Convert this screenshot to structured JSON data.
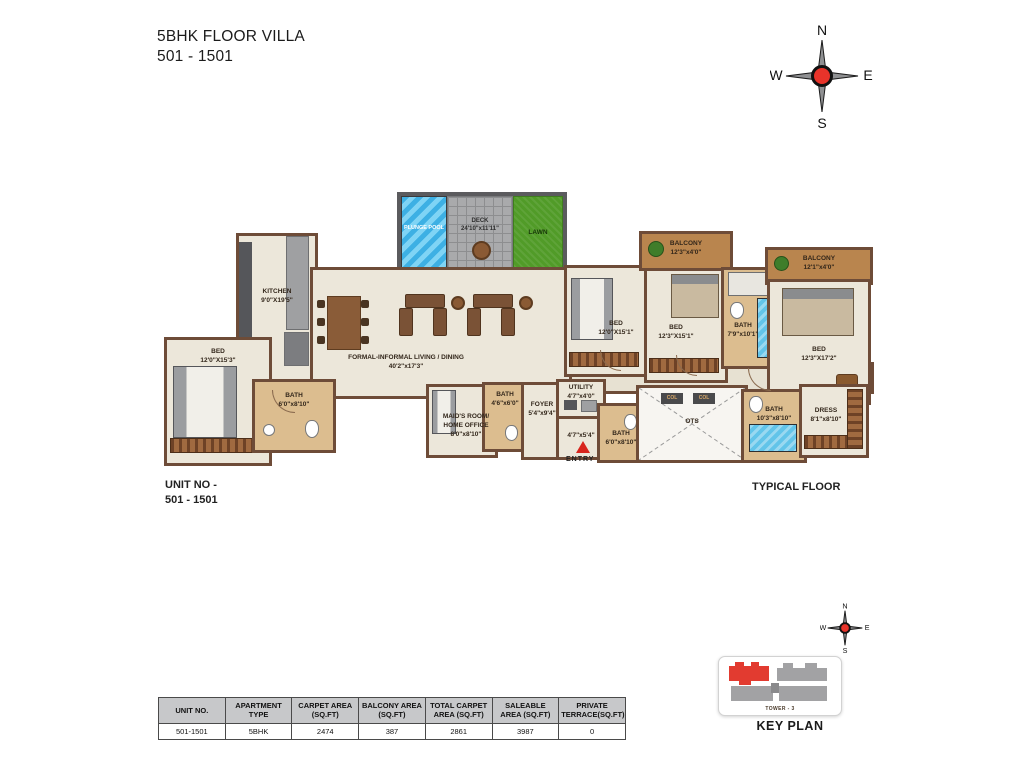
{
  "title": {
    "line1": "5BHK FLOOR VILLA",
    "line2": "501 - 1501"
  },
  "compass": {
    "n": "N",
    "e": "E",
    "s": "S",
    "w": "W"
  },
  "labels": {
    "unit_no_line1": "UNIT NO -",
    "unit_no_line2": "501 - 1501",
    "typical_floor": "TYPICAL FLOOR",
    "key_plan": "KEY PLAN",
    "tower": "TOWER - 3",
    "entry": "ENTRY"
  },
  "rooms": {
    "plunge_pool": {
      "name": "PLUNGE POOL",
      "dim": ""
    },
    "deck": {
      "name": "DECK",
      "dim": "24'10\"x11'11\""
    },
    "lawn": {
      "name": "LAWN",
      "dim": ""
    },
    "kitchen": {
      "name": "KITCHEN",
      "dim": "9'0\"X19'5\""
    },
    "living": {
      "name": "FORMAL-INFORMAL LIVING / DINING",
      "dim": "40'2\"x17'3\""
    },
    "bed1": {
      "name": "BED",
      "dim": "12'0\"X15'3\""
    },
    "bath1": {
      "name": "BATH",
      "dim": "6'0\"x8'10\""
    },
    "maids_room": {
      "name": "MAID'S ROOM/ HOME OFFICE",
      "dim": "8'0\"x8'10\""
    },
    "bath2": {
      "name": "BATH",
      "dim": "4'6\"x6'0\""
    },
    "foyer": {
      "name": "FOYER",
      "dim": "5'4\"x9'4\""
    },
    "utility": {
      "name": "UTILITY",
      "dim": "4'7\"x4'0\""
    },
    "passage": {
      "name": "",
      "dim": "4'7\"x5'4\""
    },
    "bath3": {
      "name": "BATH",
      "dim": "6'0\"x8'10\""
    },
    "bed2": {
      "name": "BED",
      "dim": "12'0\"X15'1\""
    },
    "bed3": {
      "name": "BED",
      "dim": "12'3\"X15'1\""
    },
    "balcony1": {
      "name": "BALCONY",
      "dim": "12'3\"x4'0\""
    },
    "bath4": {
      "name": "BATH",
      "dim": "7'9\"x10'1\""
    },
    "balcony2": {
      "name": "BALCONY",
      "dim": "12'1\"x4'0\""
    },
    "bed4": {
      "name": "BED",
      "dim": "12'3\"X17'2\""
    },
    "ots": {
      "name": "OTS",
      "dim": ""
    },
    "col_label": "COL",
    "bath5": {
      "name": "BATH",
      "dim": "10'3\"x8'10\""
    },
    "dress": {
      "name": "DRESS",
      "dim": "8'1\"x8'10\""
    }
  },
  "table": {
    "headers": [
      "UNIT NO.",
      "APARTMENT TYPE",
      "CARPET AREA (SQ.FT)",
      "BALCONY AREA (SQ.FT)",
      "TOTAL CARPET AREA (SQ.FT)",
      "SALEABLE AREA (SQ.FT)",
      "PRIVATE TERRACE(SQ.FT)"
    ],
    "row": [
      "501-1501",
      "5BHK",
      "2474",
      "387",
      "2861",
      "3987",
      "0"
    ]
  },
  "colors": {
    "wall_brown": "#6e4c38",
    "floor_cream": "#ece7da",
    "bath_tan": "#dcbd8f",
    "balcony_wood": "#b9854e",
    "pool_blue": "#3db0e4",
    "lawn_green": "#519b28",
    "compass_red": "#e8332a",
    "keyplan_red": "#e23b30",
    "table_header_gray": "#c7c8ca"
  }
}
